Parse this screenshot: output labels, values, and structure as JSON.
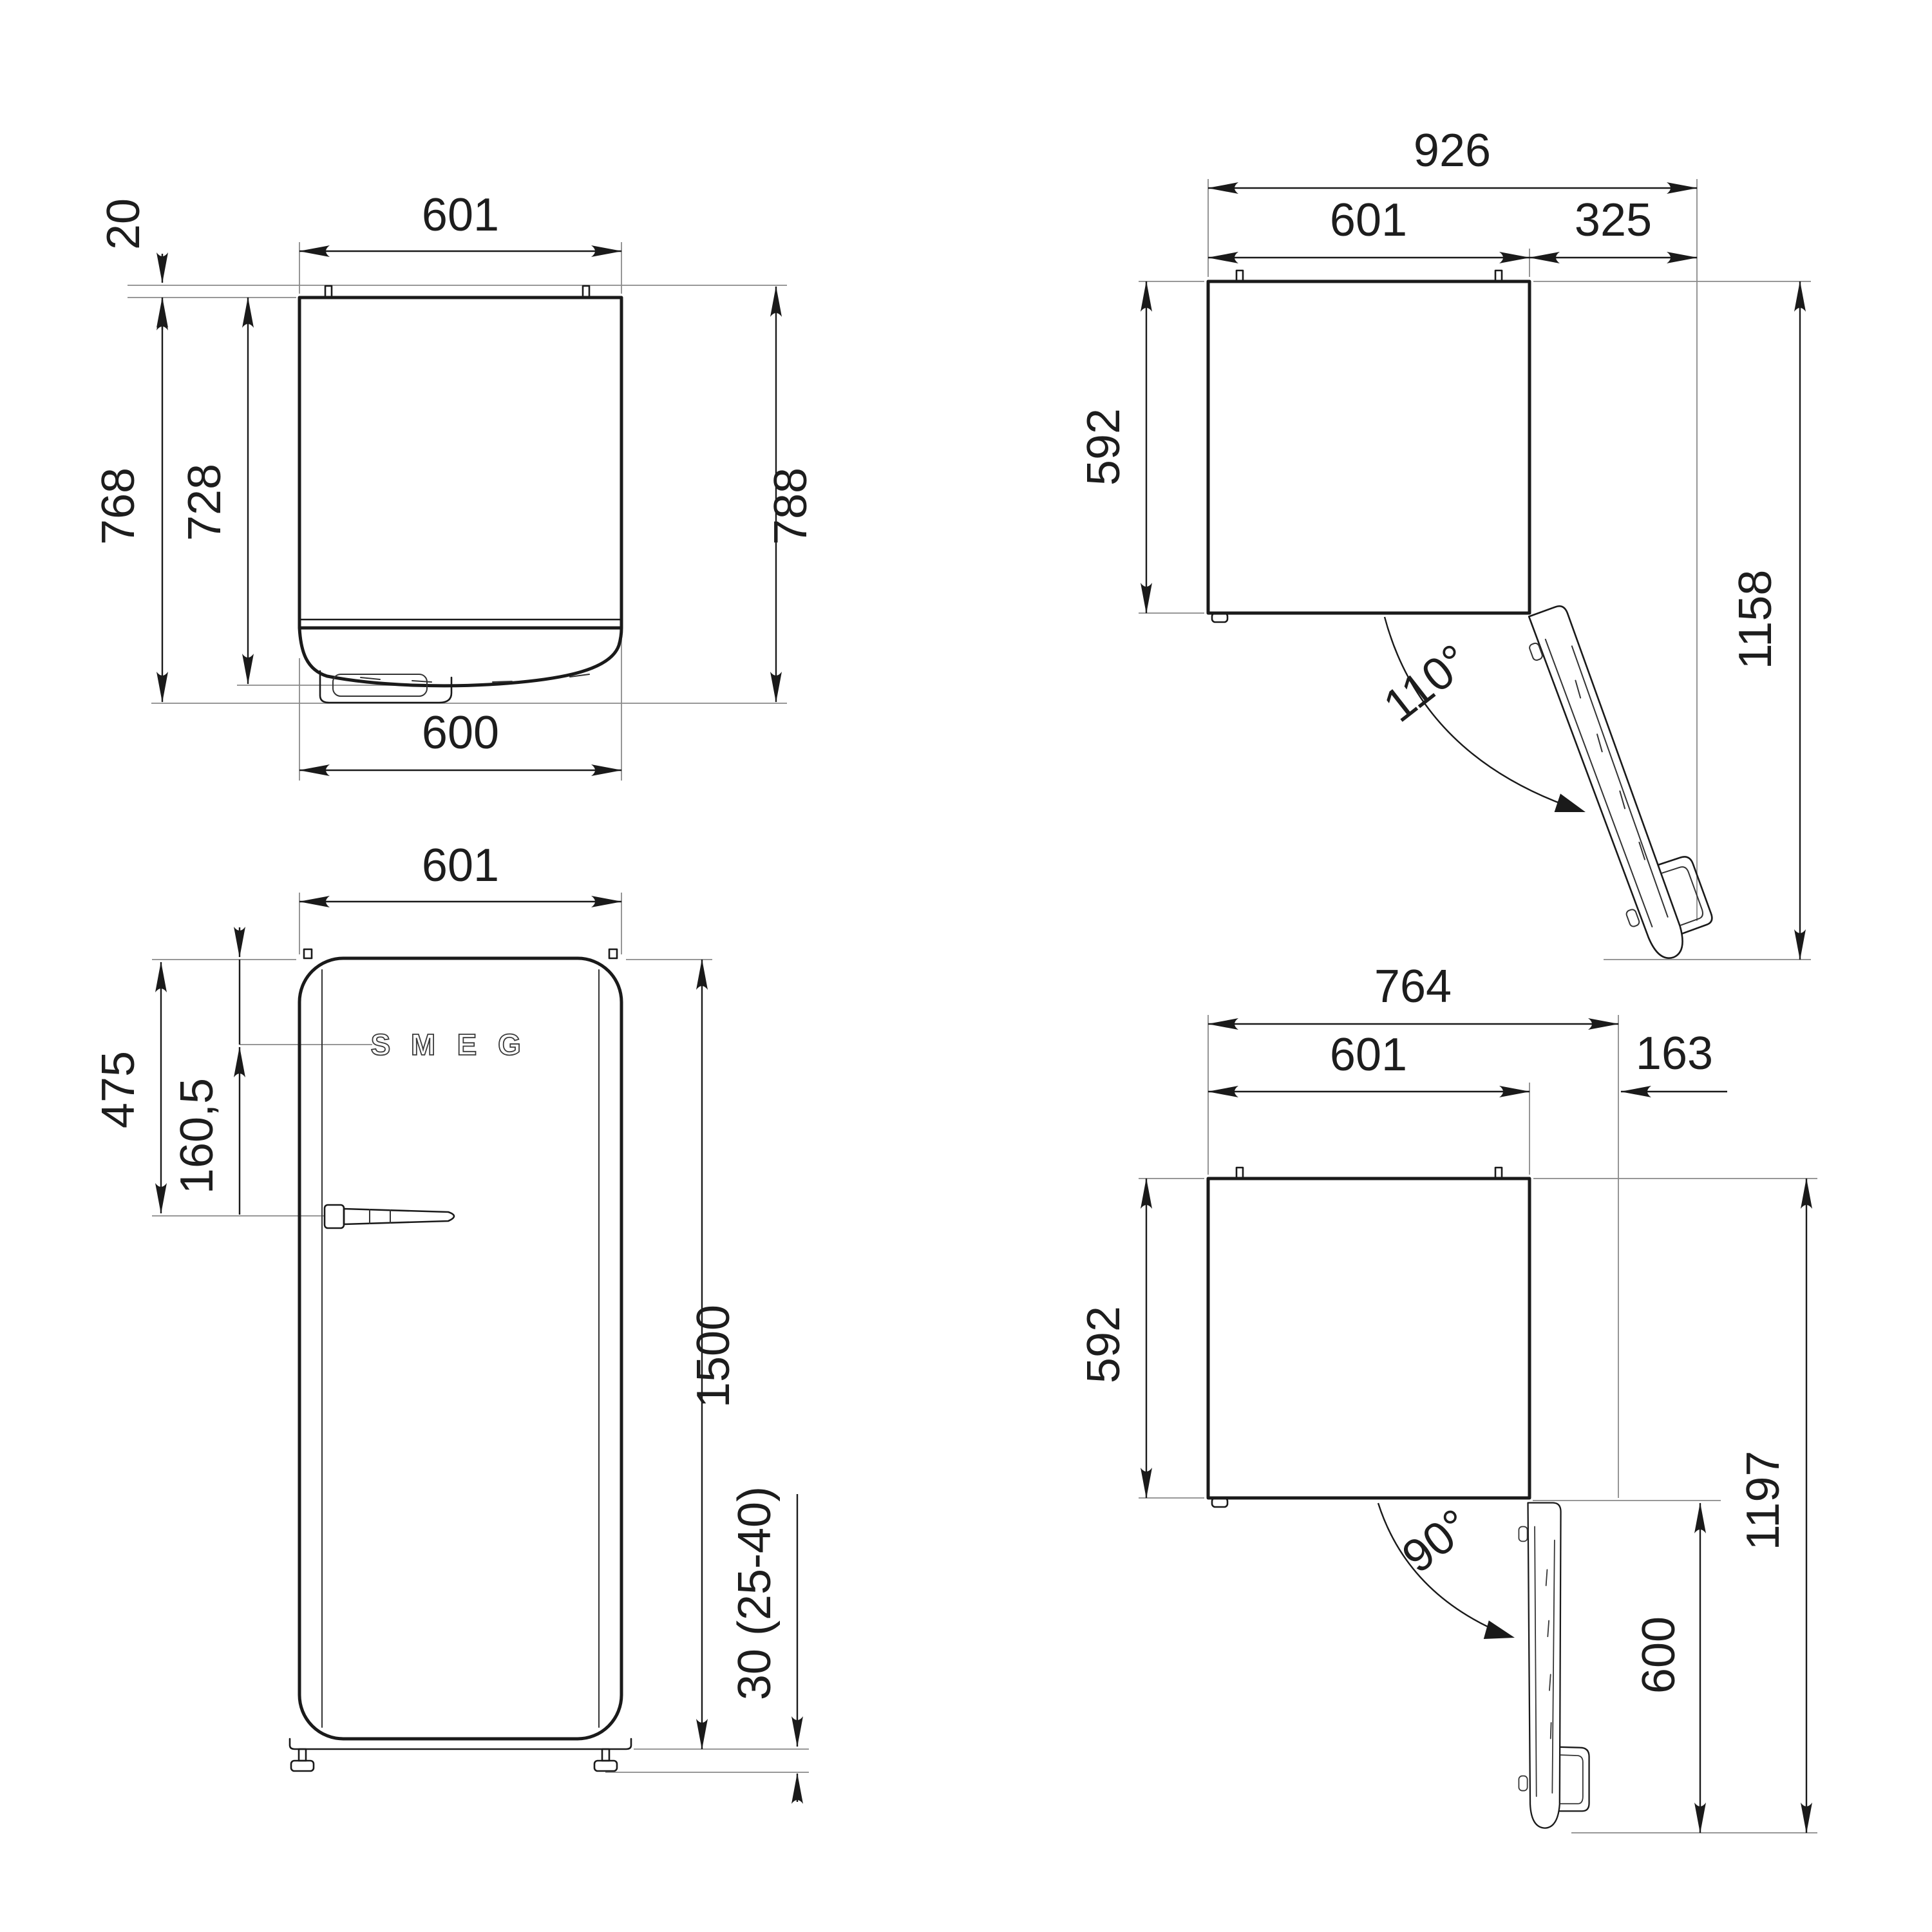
{
  "figure": {
    "type": "technical dimension drawing",
    "product": "retro single-door refrigerator",
    "background_color": "#ffffff",
    "line_color": "#1a1a1a",
    "units": "mm"
  },
  "views": {
    "top_closed": {
      "label": "top view - door closed",
      "dims": {
        "width_top": "601",
        "rear_spacer": "20",
        "depth_with_handle": "768",
        "depth_body": "728",
        "depth_overall": "788",
        "width_bottom": "600"
      }
    },
    "top_open_110": {
      "label": "top view - door open 110 degrees",
      "dims": {
        "overall_width": "926",
        "body_width": "601",
        "door_projection": "325",
        "body_depth": "592",
        "overall_depth": "1158",
        "door_angle": "110°"
      }
    },
    "front": {
      "label": "front view",
      "dims": {
        "width": "601",
        "top_to_handle": "475",
        "top_to_logo": "160,5",
        "height": "1500",
        "feet_height": "30 (25-40)"
      },
      "logo_letters": [
        "S",
        "M",
        "E",
        "G"
      ]
    },
    "top_open_90": {
      "label": "top view - door open 90 degrees",
      "dims": {
        "overall_width": "764",
        "body_width": "601",
        "door_projection": "163",
        "body_depth": "592",
        "overall_depth": "1197",
        "door_swing_depth": "600",
        "door_angle": "90°"
      }
    }
  }
}
